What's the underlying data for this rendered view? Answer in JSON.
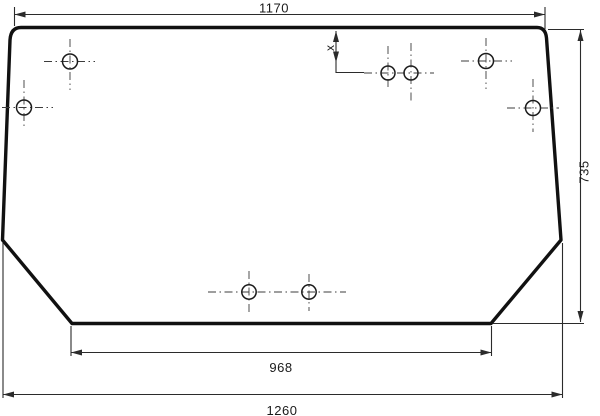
{
  "drawing": {
    "labels": {
      "top_width": "1170",
      "overall_height": "735",
      "bottom_edge_width": "968",
      "overall_width": "1260",
      "hole_offset": "x"
    },
    "colors": {
      "background": "#ffffff",
      "outline": "#111111",
      "dimension_lines": "#2b2b2b",
      "centerlines": "#3c3c3c"
    },
    "hole_count": 8
  }
}
